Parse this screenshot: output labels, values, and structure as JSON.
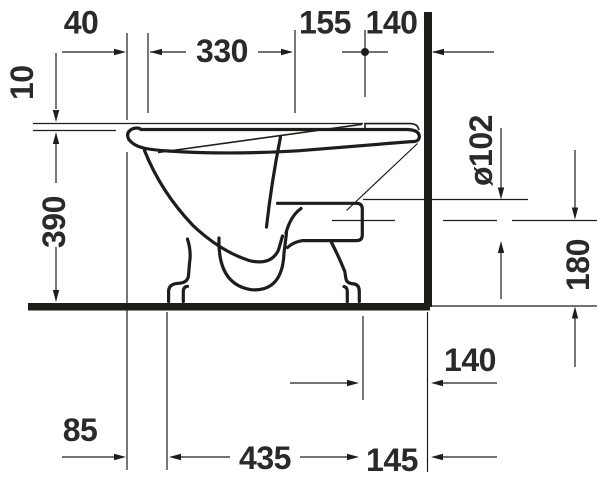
{
  "drawing": {
    "type": "sanitary-ware technical dimension drawing",
    "view": "toilet side profile against wall",
    "units": "mm",
    "colors": {
      "line": "#1d1d1b",
      "background": "#ffffff"
    },
    "dimensions": {
      "d40": "40",
      "d10": "10",
      "d330": "330",
      "d155": "155",
      "d140_top": "140",
      "d102_outlet": "ø102",
      "d390": "390",
      "d180": "180",
      "d140_bottom": "140",
      "d85": "85",
      "d435": "435",
      "d145": "145"
    }
  }
}
